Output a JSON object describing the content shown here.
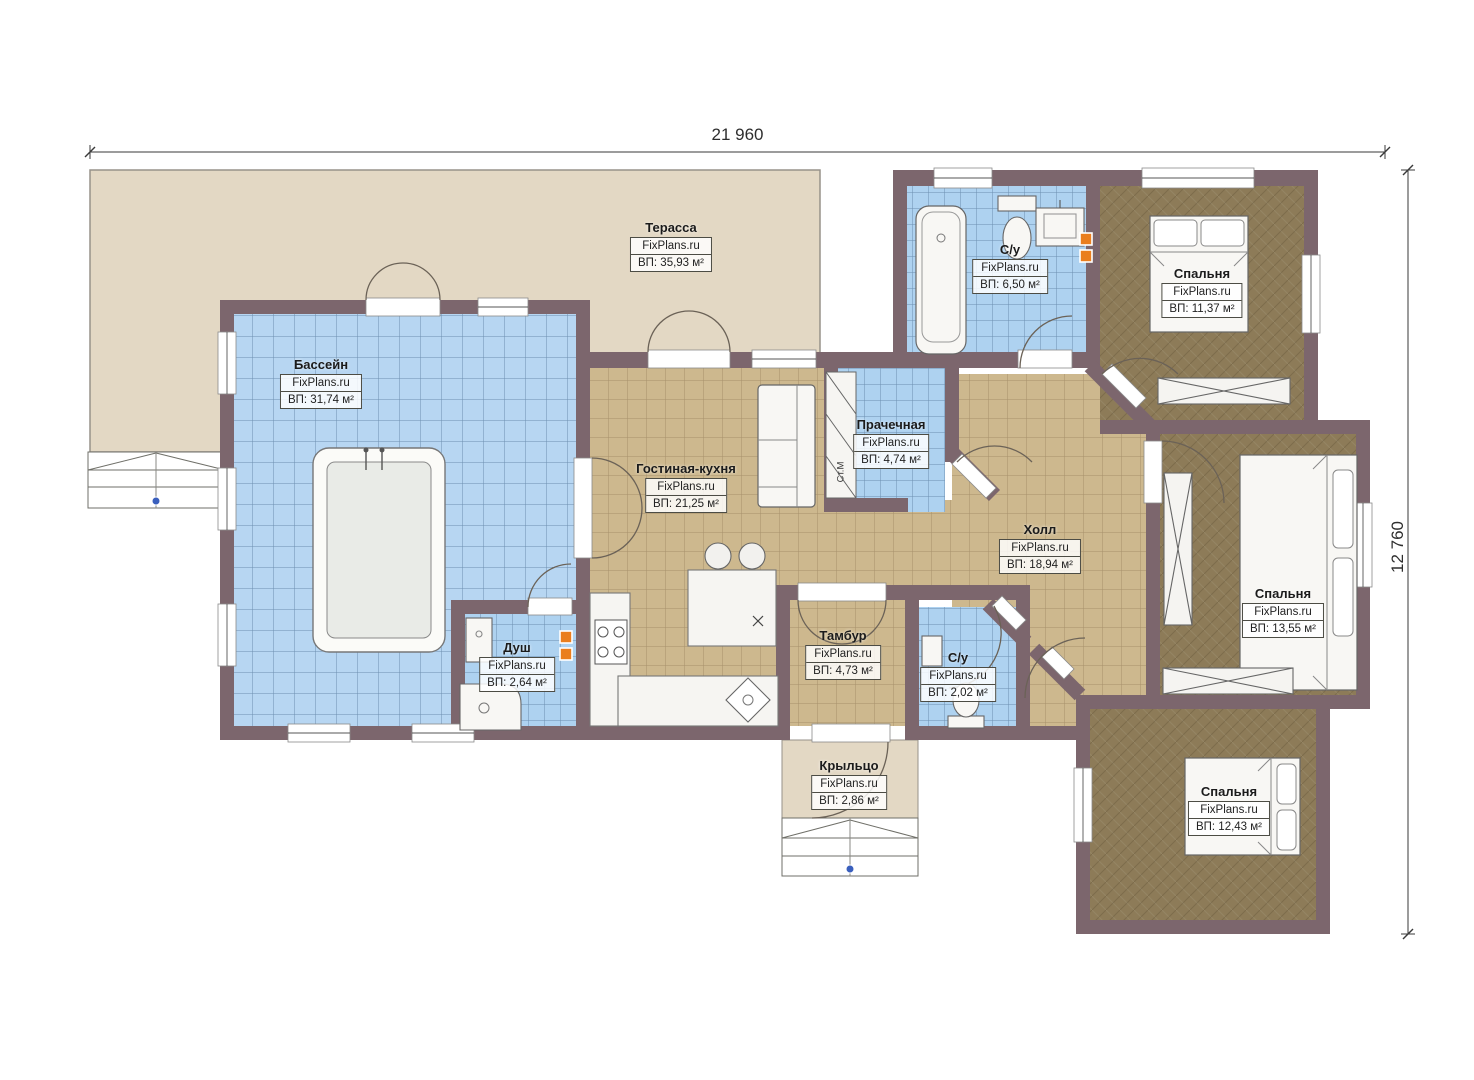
{
  "dimensions": {
    "width_label": "21 960",
    "height_label": "12 760"
  },
  "branding": {
    "watermark": "FixPlans.ru"
  },
  "annotations": {
    "washing_machine": "Ст.М"
  },
  "rooms": [
    {
      "name": "Терасса",
      "brand": "FixPlans.ru",
      "area": "ВП: 35,93 м²"
    },
    {
      "name": "Бассейн",
      "brand": "FixPlans.ru",
      "area": "ВП: 31,74 м²"
    },
    {
      "name": "Гостиная-кухня",
      "brand": "FixPlans.ru",
      "area": "ВП: 21,25 м²"
    },
    {
      "name": "Прачечная",
      "brand": "FixPlans.ru",
      "area": "ВП: 4,74 м²"
    },
    {
      "name": "С/у",
      "brand": "FixPlans.ru",
      "area": "ВП: 6,50 м²"
    },
    {
      "name": "Спальня",
      "brand": "FixPlans.ru",
      "area": "ВП: 11,37 м²"
    },
    {
      "name": "Холл",
      "brand": "FixPlans.ru",
      "area": "ВП: 18,94 м²"
    },
    {
      "name": "Спальня",
      "brand": "FixPlans.ru",
      "area": "ВП: 13,55 м²"
    },
    {
      "name": "Душ",
      "brand": "FixPlans.ru",
      "area": "ВП: 2,64 м²"
    },
    {
      "name": "Тамбур",
      "brand": "FixPlans.ru",
      "area": "ВП: 4,73 м²"
    },
    {
      "name": "С/у",
      "brand": "FixPlans.ru",
      "area": "ВП: 2,02 м²"
    },
    {
      "name": "Крыльцо",
      "brand": "FixPlans.ru",
      "area": "ВП: 2,86 м²"
    },
    {
      "name": "Спальня",
      "brand": "FixPlans.ru",
      "area": "ВП: 12,43 м²"
    }
  ],
  "colors": {
    "wall": "#7c666d",
    "pool_tile": "#b7d6f2",
    "floor_tile": "#cdb88e",
    "wood_floor": "#8d7b58",
    "terrace": "#e3d8c4",
    "marker_orange": "#ea7e1e"
  }
}
